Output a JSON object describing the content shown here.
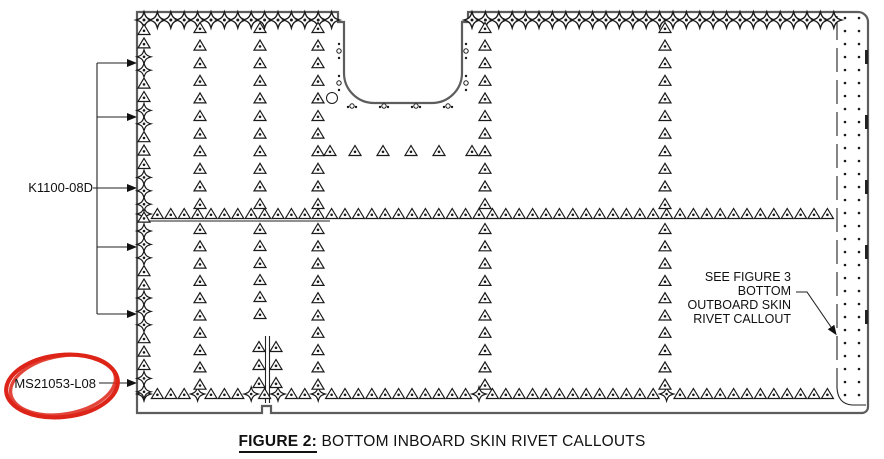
{
  "figure": {
    "caption_label": "FIGURE 2:",
    "caption_text": " BOTTOM INBOARD SKIN RIVET CALLOUTS"
  },
  "labels": {
    "part_left": "K1100-08D",
    "part_bottom": "MS21053-L08"
  },
  "see_figure_note": {
    "line1": "SEE FIGURE 3",
    "line2": "BOTTOM",
    "line3": "OUTBOARD SKIN",
    "line4": "RIVET CALLOUT"
  },
  "colors": {
    "line": "#222222",
    "panel_outline": "#5d5d5d",
    "highlight_red": "#dd2418",
    "background": "#ffffff"
  },
  "symbols": {
    "triangle": "countersunk-rivet-triangle-icon",
    "star": "flush-rivet-star-icon",
    "dot": "fastener-hole-dot-icon"
  },
  "diagram": {
    "width": 884,
    "height": 459,
    "panel_path": "M137,12 H338 v10 h6 v51 a30,30 0 0 0 30,30 h58 a30,30 0 0 0 30,-30 v-51 h6 v-10 H858 a10,10 0 0 1 10,10 V407 a6,6 0 0 1 -6,6 H271 v-7 h-9 v7 H137 Z",
    "mid_line": {
      "x1": 137,
      "y1": 221,
      "x2": 330,
      "y2": 221
    },
    "star_rows": [
      {
        "y": 20,
        "step": 13.4,
        "scale": 1.15,
        "segments": [
          [
            144,
            332
          ],
          [
            472,
            834
          ]
        ]
      }
    ],
    "tri_rows": [
      {
        "y": 214,
        "x1": 144,
        "x2": 834,
        "step": 13.4,
        "star_idx": [
          0
        ]
      },
      {
        "y": 394,
        "x1": 144,
        "x2": 834,
        "step": 13.4,
        "star_idx": [
          0,
          4,
          8,
          10,
          13,
          25,
          39
        ]
      },
      {
        "y": 151,
        "xs": [
          330,
          355,
          383,
          411,
          439,
          472
        ]
      }
    ],
    "left_edge": {
      "x": 144,
      "y1": 30,
      "y2": 392,
      "step": 13.4,
      "arrow_ys": [
        63,
        117,
        188,
        247,
        314,
        383
      ],
      "star_dist": 17
    },
    "columns": [
      {
        "x": 200,
        "runs": [
          [
            28,
            204,
            17.6
          ],
          [
            229,
            385,
            17.3
          ]
        ]
      },
      {
        "x": 260,
        "runs": [
          [
            28,
            204,
            17.6
          ],
          [
            229,
            330,
            17.0
          ]
        ]
      },
      {
        "x": 318,
        "runs": [
          [
            28,
            204,
            17.6
          ],
          [
            229,
            385,
            17.3
          ]
        ]
      },
      {
        "x": 485,
        "runs": [
          [
            28,
            204,
            17.6
          ],
          [
            229,
            385,
            17.3
          ]
        ]
      },
      {
        "x": 665,
        "runs": [
          [
            28,
            204,
            17.6
          ],
          [
            229,
            385,
            17.3
          ]
        ]
      }
    ],
    "pair_columns": {
      "xs": [
        259,
        276
      ],
      "ys": [
        347,
        365,
        383
      ]
    },
    "stringer": {
      "x1": 265.5,
      "x2": 269.5,
      "y1": 336,
      "y2": 403
    },
    "open_circle": {
      "cx": 332,
      "cy": 98,
      "r": 5.5
    },
    "notch_side_dots": {
      "xs": [
        339,
        466
      ],
      "groups": [
        [
          44,
          51,
          58
        ],
        [
          76,
          83,
          90
        ]
      ]
    },
    "notch_bottom_dots": {
      "y": 107,
      "groups": [
        [
          348,
          352,
          356
        ],
        [
          380,
          384,
          388
        ],
        [
          412,
          416,
          420
        ],
        [
          444,
          448,
          452
        ]
      ]
    },
    "strip": {
      "dash_x": 837,
      "dash_y1": 16,
      "dash_y2": 388,
      "curve": "M837,388 Q838,404 852,405 H866",
      "dot_cols": [
        845,
        859
      ],
      "dot_y1": 18,
      "dot_y2": 404,
      "dot_step": 13,
      "edge_dash_x": 866.5,
      "edge_dash_ys": [
        50,
        115,
        180,
        245,
        310
      ],
      "edge_dash_len": 14
    },
    "callout": {
      "bus_x": 97,
      "bus_y1": 63,
      "bus_y2": 314,
      "branch_ys": [
        63,
        117,
        247,
        314
      ],
      "branch_x2": 127,
      "label_line": {
        "x1": 93,
        "x2": 127,
        "y": 188
      },
      "ms_line": {
        "x1": 99,
        "x2": 127,
        "y": 383
      }
    },
    "see_leader": "M796,292 h11 l24,35",
    "red_ellipse": {
      "cx": 62,
      "cy": 386,
      "rx": 56,
      "ry": 31,
      "rot": -6
    }
  }
}
